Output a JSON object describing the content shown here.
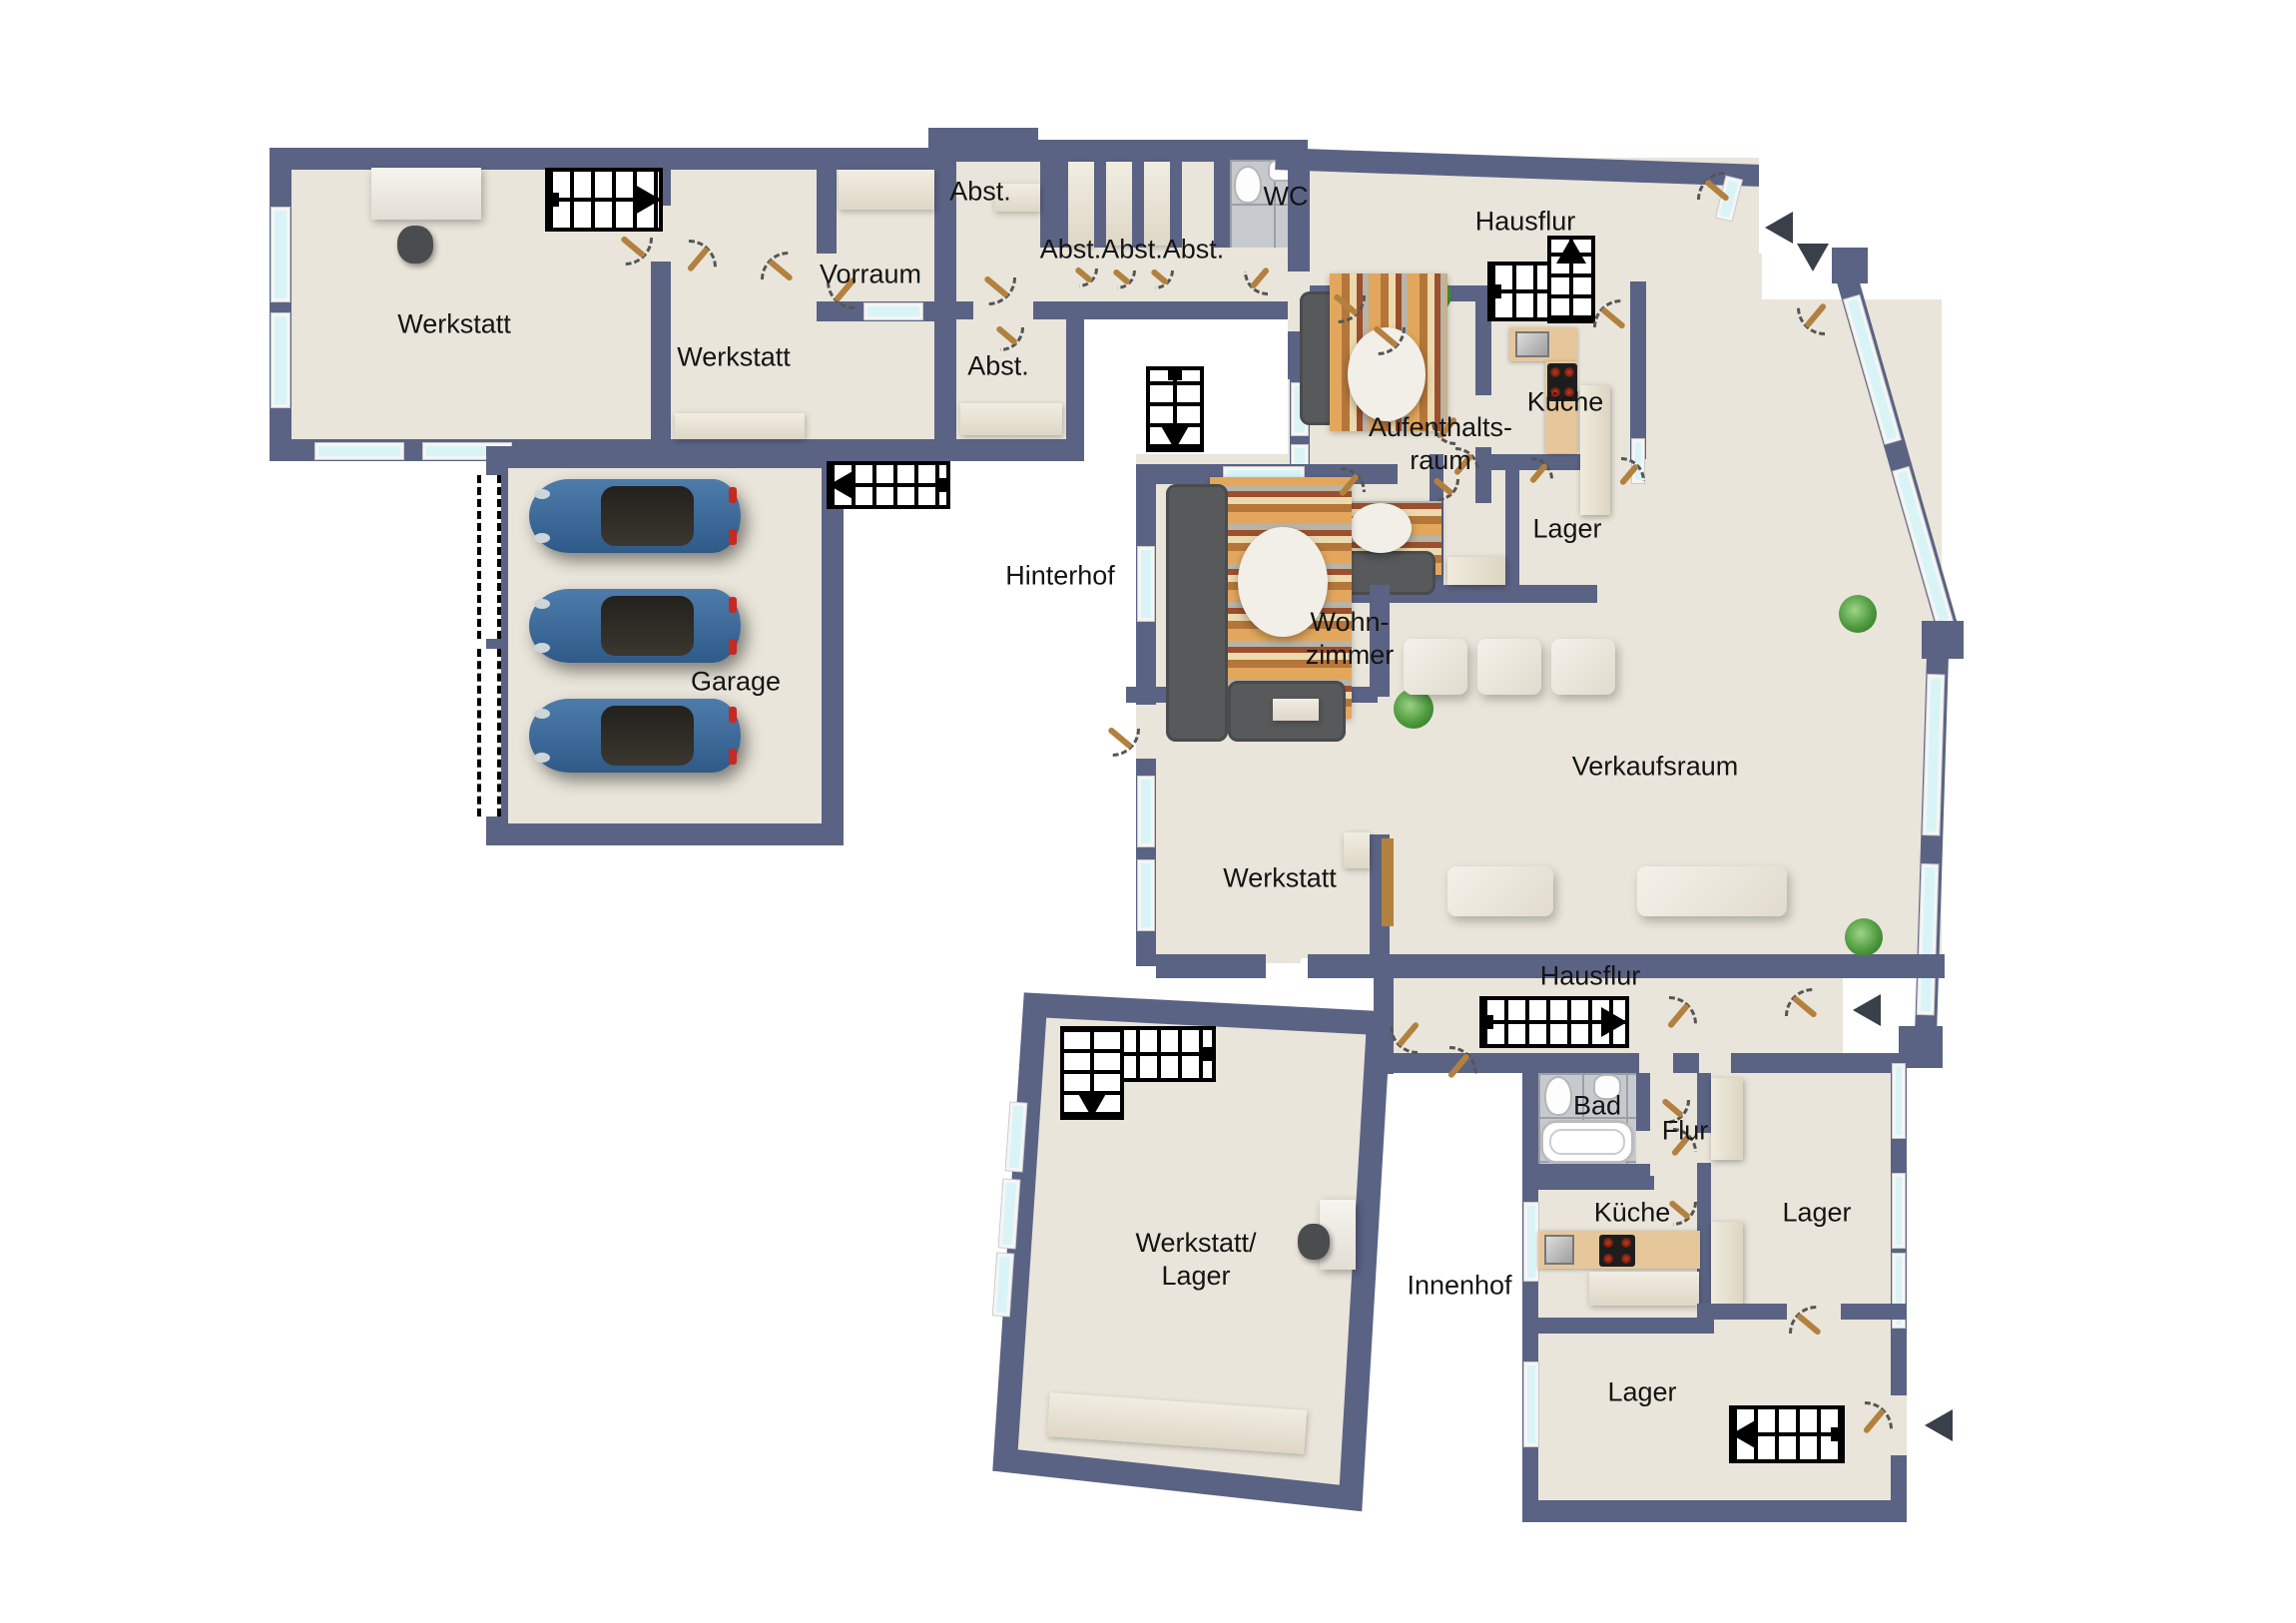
{
  "colors": {
    "wall": "#5b6384",
    "floor": "#e9e5da",
    "outside": "#ffffff",
    "window_glass": "#d9f4f6",
    "door_leaf": "#b3813f",
    "stair_line": "#000000",
    "entry_arrow": "#3a4049",
    "sofa": "#58595b",
    "rug_accent": "#b5763a",
    "kitchen_counter": "#e6c79c",
    "car": "#2f5a88",
    "plant": "#4e9a3e",
    "bath_tile": "#c6cacf"
  },
  "symbols": {
    "entry_arrow_left": "◀",
    "entry_arrow_down": "▼",
    "stair_direction_up": "▲",
    "stair_direction_down": "▼"
  },
  "rooms": {
    "werkstatt_nw": {
      "label": "Werkstatt"
    },
    "werkstatt_nw2": {
      "label": "Werkstatt"
    },
    "vorraum": {
      "label": "Vorraum"
    },
    "abst_nw": {
      "label": "Abst."
    },
    "abst_row": {
      "label": "Abst.Abst.Abst."
    },
    "abst_mid": {
      "label": "Abst."
    },
    "wc": {
      "label": "WC"
    },
    "hausflur_top": {
      "label": "Hausflur"
    },
    "aufenthaltsraum": {
      "line1": "Aufenthalts-",
      "line2": "raum"
    },
    "kueche_top": {
      "label": "Küche"
    },
    "lager_top": {
      "label": "Lager"
    },
    "wohnzimmer": {
      "line1": "Wohn-",
      "line2": "zimmer"
    },
    "garage": {
      "label": "Garage"
    },
    "verkaufsraum": {
      "label": "Verkaufsraum"
    },
    "werkstatt_mid": {
      "label": "Werkstatt"
    },
    "hausflur_low": {
      "label": "Hausflur"
    },
    "bad": {
      "label": "Bad"
    },
    "flur": {
      "label": "Flur"
    },
    "kueche_low": {
      "label": "Küche"
    },
    "lager_right": {
      "label": "Lager"
    },
    "lager_low": {
      "label": "Lager"
    },
    "werkstatt_lager": {
      "line1": "Werkstatt/",
      "line2": "Lager"
    }
  },
  "outdoor": {
    "hinterhof": {
      "label": "Hinterhof"
    },
    "innenhof": {
      "label": "Innenhof"
    }
  }
}
